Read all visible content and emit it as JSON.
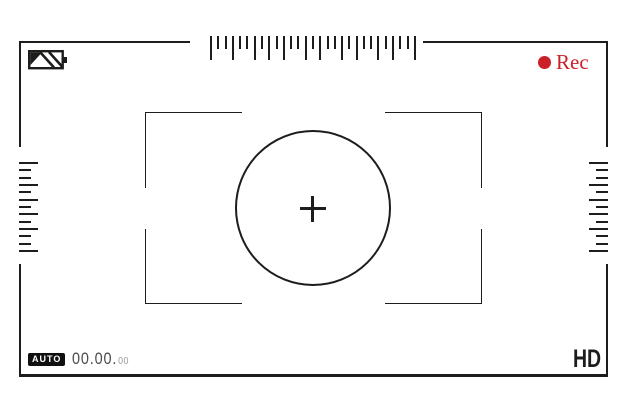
{
  "meta": {
    "title": "Camera viewfinder screen"
  },
  "colors": {
    "line": "#1d1d1b",
    "rec_red": "#cb2027",
    "timecode_main": "#4a4a4a",
    "timecode_small": "#9b9b9b",
    "background": "#ffffff"
  },
  "status_bar": {
    "battery_icon": "battery-diagonal-stripes",
    "rec": {
      "dot_icon": "record-dot",
      "label": "Rec"
    }
  },
  "reticle": {
    "focus_circle": "focus-circle",
    "crosshair_icon": "crosshair",
    "corner_brackets": [
      "top-left",
      "top-right",
      "bottom-left",
      "bottom-right"
    ]
  },
  "scales": {
    "top_ticks": [
      "tall",
      "short",
      "short",
      "tall",
      "short",
      "short",
      "tall",
      "short",
      "tall",
      "short",
      "tall",
      "short",
      "short",
      "tall",
      "short",
      "tall",
      "short",
      "short",
      "tall",
      "short",
      "tall",
      "short",
      "short",
      "tall",
      "short",
      "tall",
      "short",
      "short",
      "tall"
    ],
    "left_ticks": [
      "long",
      "short",
      "short",
      "long",
      "short",
      "long",
      "short",
      "long",
      "short",
      "long",
      "short",
      "short",
      "long"
    ],
    "right_ticks": [
      "long",
      "short",
      "short",
      "long",
      "short",
      "long",
      "short",
      "long",
      "short",
      "long",
      "short",
      "short",
      "long"
    ]
  },
  "bottom_bar": {
    "auto_label": "AUTO",
    "timecode": {
      "main": "00.00.",
      "small": "00"
    },
    "hd_label": "HD"
  }
}
